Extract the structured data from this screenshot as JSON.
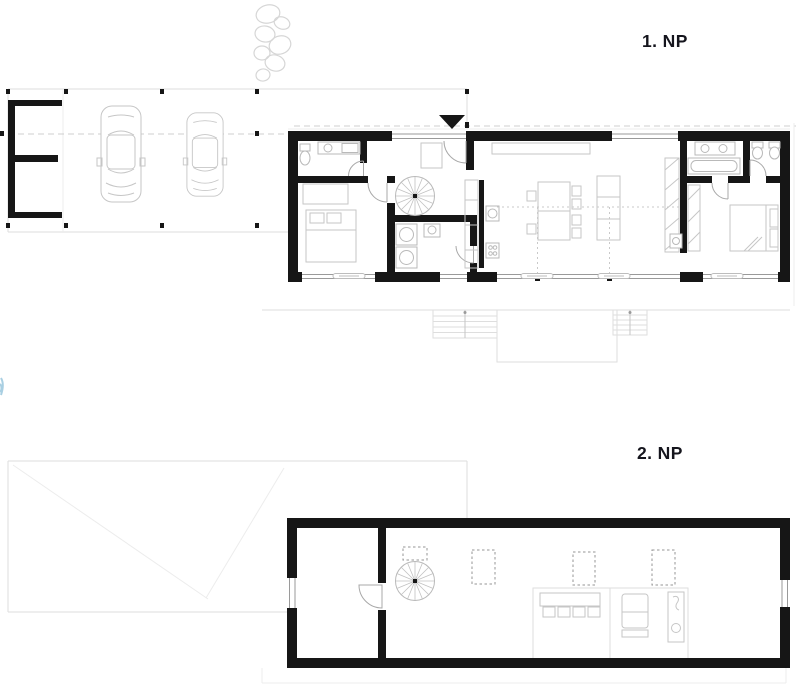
{
  "sheet": {
    "width": 800,
    "height": 692,
    "background": "#ffffff",
    "kind": "architectural floor plan drawing"
  },
  "plans": [
    {
      "id": "floor-1",
      "label": "1. NP",
      "contents": [
        "carport with two cars",
        "storage room",
        "entrance marker",
        "entry hall",
        "bathroom",
        "bedroom",
        "spiral staircase",
        "small bathroom with washer and dryer",
        "kitchen with tall cabinets",
        "dining table with chairs",
        "kitchen island",
        "wardrobe corridor",
        "master bedroom",
        "master bathroom with two toilets",
        "glazed south facade with sliding doors",
        "terrace line with two exterior stairs and patio"
      ]
    },
    {
      "id": "floor-2",
      "label": "2. NP",
      "contents": [
        "carport roof outline with valley lines",
        "gallery room",
        "door",
        "spiral staircase",
        "skylight openings",
        "study zone with long desk and four chairs",
        "chaise",
        "small sanitary unit"
      ]
    }
  ],
  "colors": {
    "wall": "#161616",
    "furniture_line": "#c6c6c6",
    "light_line": "#dedede",
    "dashed_axis": "#cfcfcf",
    "glazing_line": "#9a9a9a",
    "label_text": "#15151d",
    "vegetation_line": "#d6d6d6",
    "accent_mark": "#a9cfe2"
  }
}
